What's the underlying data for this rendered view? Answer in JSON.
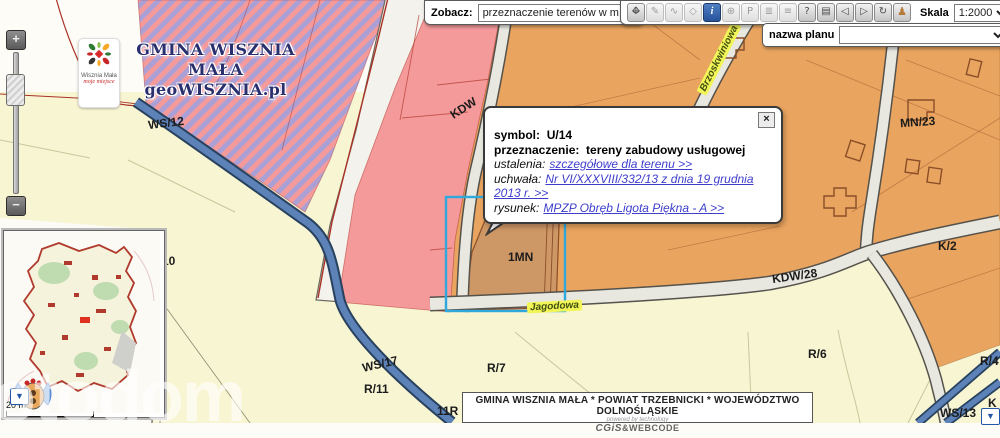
{
  "branding": {
    "municipality": "GMINA WISZNIA MAŁA",
    "site": "geoWISZNIA.pl",
    "logo_title": "Wisznia Mała",
    "logo_tagline": "moje miejsce"
  },
  "toolbar": {
    "view_label": "Zobacz:",
    "view_value": "przeznaczenie terenów w mpzp",
    "scale_label": "Skala",
    "scale_value": "1:2000",
    "buttons": [
      {
        "name": "pan",
        "glyph_h": "↔",
        "glyph_v": "↕"
      },
      {
        "name": "measure",
        "glyph": "✎"
      },
      {
        "name": "measure-line",
        "glyph": "∿"
      },
      {
        "name": "measure-area",
        "glyph": "◇"
      },
      {
        "name": "info",
        "glyph": "i"
      },
      {
        "name": "globe",
        "glyph": "⊕"
      },
      {
        "name": "parking",
        "glyph": "P"
      },
      {
        "name": "layers",
        "glyph": "≣"
      },
      {
        "name": "legend",
        "glyph": "≡"
      },
      {
        "name": "help",
        "glyph": "?"
      },
      {
        "name": "print",
        "glyph": "▤"
      },
      {
        "name": "back",
        "glyph": "◁"
      },
      {
        "name": "forward",
        "glyph": "▷"
      },
      {
        "name": "refresh",
        "glyph": "↻"
      },
      {
        "name": "user",
        "glyph": "♟"
      }
    ]
  },
  "plan_bar": {
    "label": "nazwa planu",
    "value": ""
  },
  "zoom_control": {
    "plus": "+",
    "minus": "−"
  },
  "popup": {
    "close": "×",
    "symbol_label": "symbol:",
    "symbol_value": "U/14",
    "purpose_label": "przeznaczenie:",
    "purpose_value": "tereny zabudowy usługowej",
    "findings_label": "ustalenia:",
    "findings_link": "szczegółowe dla terenu >>",
    "resolution_label": "uchwała:",
    "resolution_link": "Nr VI/XXXVIII/332/13 z dnia 19 grudnia 2013 r. >>",
    "drawing_label": "rysunek:",
    "drawing_link": "MPZP Obręb Ligota Piękna - A >>"
  },
  "map_labels": {
    "ws12": "WS/12",
    "kdw": "KDW",
    "mn23": "MN/23",
    "mn27": "MN/27",
    "k2": "K/2",
    "kdw28": "KDW/28",
    "u14_fragment": "4",
    "mn1": "1MN",
    "frag10": "10",
    "ws17": "WS/17",
    "r11": "R/11",
    "r7": "R/7",
    "r6": "R/6",
    "r4": "R/4",
    "r11r": "11R",
    "ws13": "WS/13",
    "k_fragment": "K"
  },
  "street_labels": {
    "jagodowa": "Jagodowa",
    "brzoskwiniowa": "Brzoskwiniowa"
  },
  "markers": {
    "inset_arrow": "▼",
    "map_arrow": "▼"
  },
  "scalebar": {
    "label": "20 m"
  },
  "footer": {
    "line": "GMINA WISZNIA MAŁA * POWIAT TRZEBNICKI * WOJEWÓDZTWO DOLNOŚLĄSKIE",
    "powered": "powered by technology",
    "brand_cg": "CGiS",
    "brand_amp": "&",
    "brand_webcode": "WEBCODE"
  },
  "watermark": "otodom",
  "colors": {
    "zone_pink": "#F59A9B",
    "zone_purple": "#ABA0D6",
    "zone_orange": "#E9A45F",
    "zone_1mn": "#CE9766",
    "zone_cream": "#F8F5D3",
    "stream_blue": "#5C82B8",
    "selection_blue": "#2FA8DC",
    "link_blue": "#3E3ECC",
    "active_button_blue": "#28529B"
  }
}
